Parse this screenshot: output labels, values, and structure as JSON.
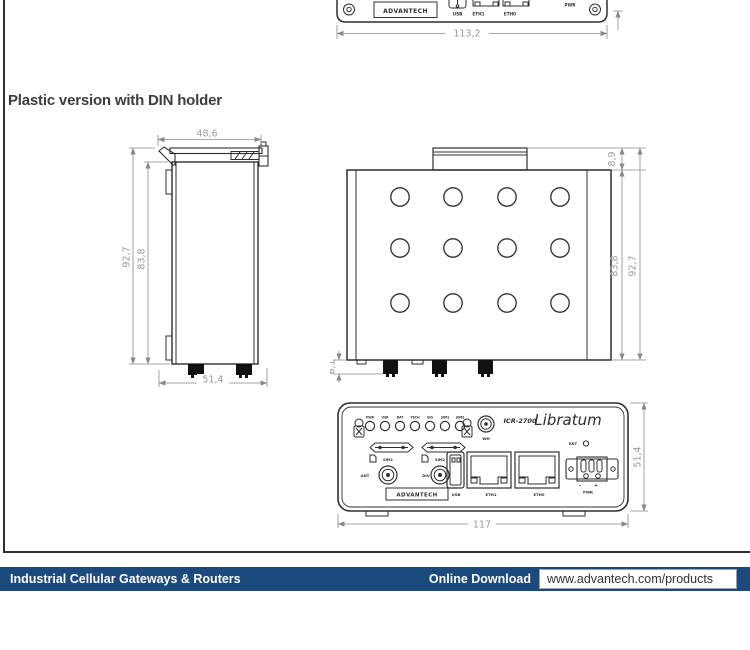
{
  "page": {
    "heading": "Plastic version with DIN holder"
  },
  "colors": {
    "footer_navy": "#1c4a7c",
    "drawing_line": "#2f2f2f",
    "dimension_gray": "#9a9a9a"
  },
  "top_view": {
    "brand": "ADVANTECH",
    "usb": "USB",
    "eth1": "ETH1",
    "eth0": "ETH0",
    "pwr": "PWR",
    "dim_width": "113,2"
  },
  "side_view": {
    "dim_top_width": "48,6",
    "dim_outer_height": "92,7",
    "dim_inner_height": "83,8",
    "dim_bottom_width": "51,4"
  },
  "back_view": {
    "dim_clip_height": "8,9",
    "dim_inner_height": "83,8",
    "dim_outer_height": "92,7",
    "dim_connector_height": "6,1"
  },
  "front_view": {
    "led_labels": [
      "PWR",
      "USR",
      "DAT",
      "TECH",
      "SIG",
      "SIM1",
      "SIM2"
    ],
    "wifi_port": "WH",
    "model": "ICR-2700",
    "series": "Libratum",
    "sim_slot1": "SIM1",
    "sim_slot2": "SIM2",
    "ant_port": "ANT",
    "div_port": "DIV",
    "brand": "ADVANTECH",
    "usb_port": "USB",
    "eth1_port": "ETH1",
    "eth0_port": "ETH0",
    "reset": "RST",
    "power": "PWR",
    "minus": "-",
    "plus": "+",
    "dim_height": "51,4",
    "dim_width": "117"
  },
  "footer": {
    "category": "Industrial Cellular Gateways & Routers",
    "download_label": "Online Download",
    "url": "www.advantech.com/products"
  }
}
